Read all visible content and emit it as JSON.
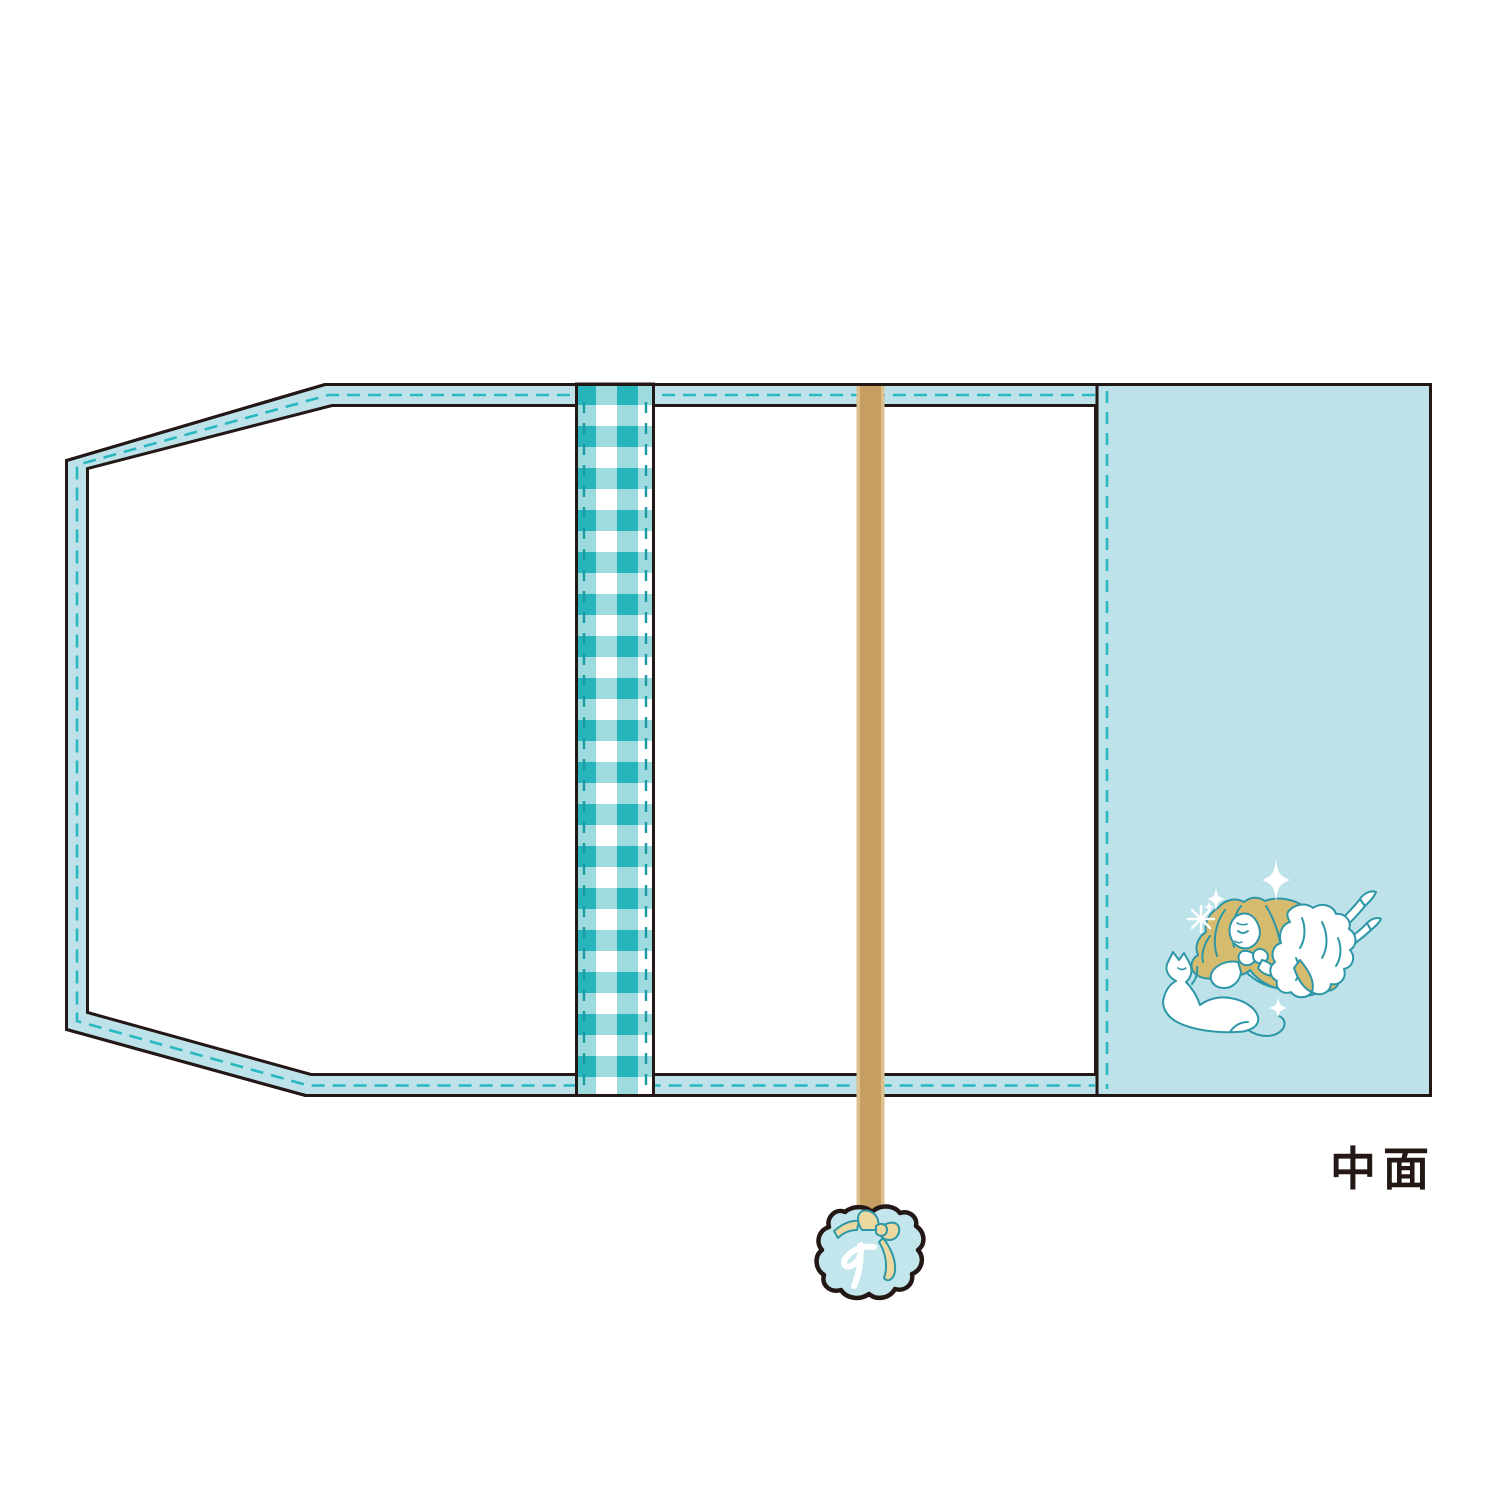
{
  "label": {
    "text": "中面"
  },
  "colors": {
    "outline": "#231815",
    "panel_blue": "#bde2e9",
    "stitch_teal": "#2ab8c0",
    "gingham_teal": "#27b4bb",
    "gingham_light": "#9ddbdf",
    "gingham_stitch": "#1a9aa2",
    "ribbon_tan": "#c79e61",
    "ribbon_tan_light": "#dcc18f",
    "hair_blonde": "#d5bb6e",
    "lineart_teal": "#2e97a7",
    "charm_blue": "#c3e6ec",
    "bow_cream": "#ecd9a0",
    "paper_white": "#ffffff"
  },
  "icons": {
    "gingham_strip": "gingham-ribbon-strip",
    "bookmark_ribbon": "bookmark-ribbon",
    "charm": "ribbon-charm-icon",
    "charm_bow": "bow-icon",
    "charm_mark": "cursive-initial-mark",
    "illustration": "girl-lying-with-cat-illustration",
    "sparkles": "sparkle-icon"
  }
}
